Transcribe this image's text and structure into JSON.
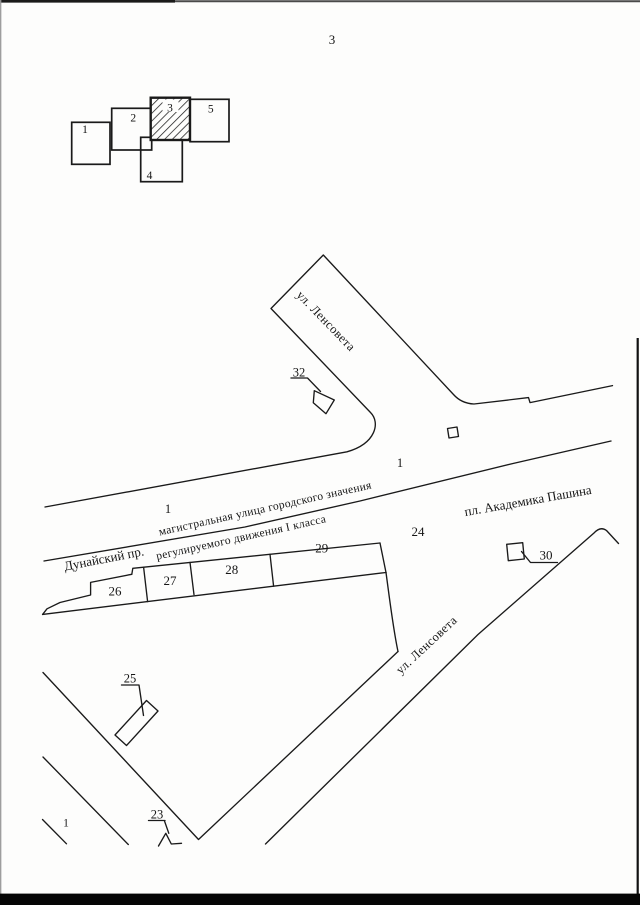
{
  "page": {
    "number": "3"
  },
  "index_map": {
    "sheets": [
      "1",
      "2",
      "3",
      "4",
      "5"
    ]
  },
  "map": {
    "streets": {
      "lensoveta_upper": "ул. Ленсовета",
      "lensoveta_lower": "ул. Ленсовета",
      "dunaysky": "Дунайский пр.",
      "pashina": "пл. Академика Пашина"
    },
    "road_class": {
      "line1": "магистральная улица городского значения",
      "line2": "регулируемого движения I класса"
    },
    "zone_labels": [
      "1",
      "1",
      "1"
    ],
    "plots": {
      "p23": "23",
      "p24": "24",
      "p25": "25",
      "p26": "26",
      "p27": "27",
      "p28": "28",
      "p29": "29",
      "p30": "30",
      "p32": "32"
    }
  },
  "colors": {
    "ink": "#1a1a1a",
    "paper": "#fdfdfc"
  }
}
